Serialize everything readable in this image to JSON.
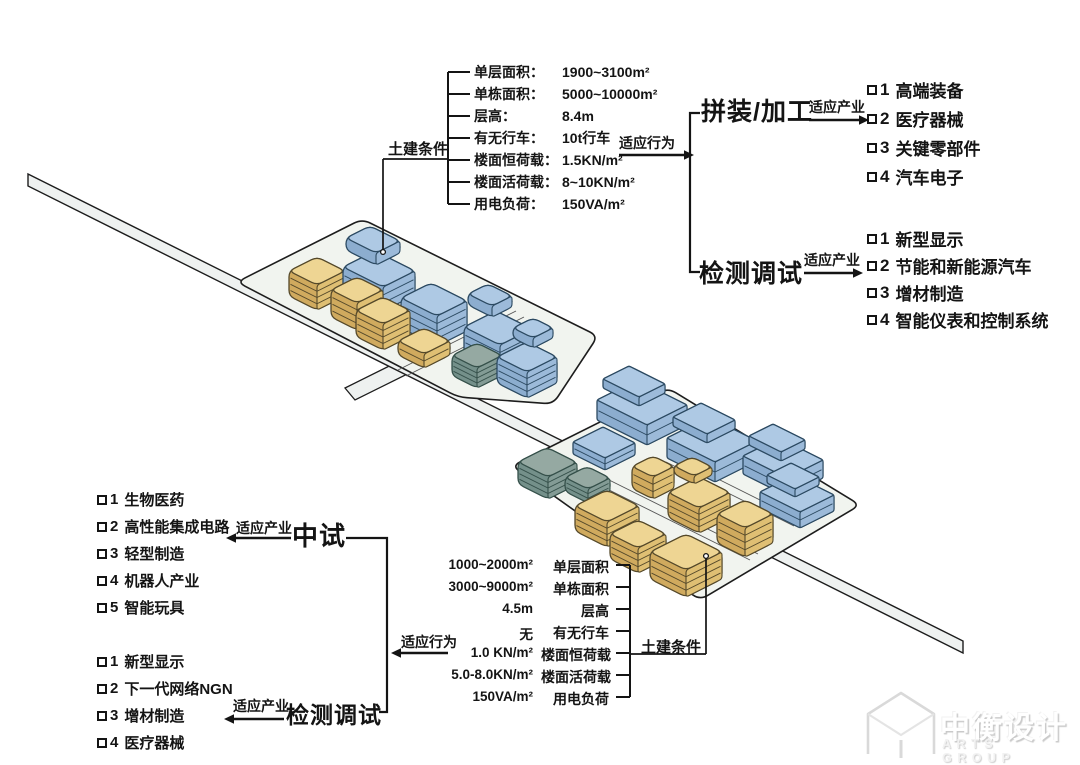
{
  "palette": {
    "ink": "#141414",
    "blue_top": "#aec9e4",
    "blue_left": "#8cadcf",
    "blue_right": "#9cbad9",
    "blue_line": "#2c4a62",
    "yellow_top": "#eed593",
    "yellow_left": "#d0aa5e",
    "yellow_right": "#dfbf73",
    "yellow_line": "#55492a",
    "teal_top": "#95a9a2",
    "teal_left": "#74908a",
    "teal_right": "#839b95",
    "teal_line": "#35504a",
    "plate": "#f1f4ef",
    "road": "#eef1f0",
    "outline": "#1d1d1d"
  },
  "top_conditions": {
    "title": "土建条件",
    "rows": [
      {
        "label": "单层面积：",
        "value": "1900~3100m²"
      },
      {
        "label": "单栋面积：",
        "value": "5000~10000m²"
      },
      {
        "label": "层高：",
        "value": "8.4m"
      },
      {
        "label": "有无行车：",
        "value": "10t行车"
      },
      {
        "label": "楼面恒荷载：",
        "value": "1.5KN/m²"
      },
      {
        "label": "楼面活荷载：",
        "value": "8~10KN/m²"
      },
      {
        "label": "用电负荷：",
        "value": "150VA/m²"
      }
    ]
  },
  "bottom_conditions": {
    "title": "土建条件",
    "rows": [
      {
        "value": "1000~2000m²",
        "label": "单层面积"
      },
      {
        "value": "3000~9000m²",
        "label": "单栋面积"
      },
      {
        "value": "4.5m",
        "label": "层高"
      },
      {
        "value": "无",
        "label": "有无行车"
      },
      {
        "value": "1.0 KN/m²",
        "label": "楼面恒荷载"
      },
      {
        "value": "5.0-8.0KN/m²",
        "label": "楼面活荷载"
      },
      {
        "value": "150VA/m²",
        "label": "用电负荷"
      }
    ]
  },
  "flows": {
    "behavior_top": "适应行为",
    "behavior_bottom": "适应行为",
    "right": [
      {
        "name": "拼装/加工",
        "arrow": "适应产业",
        "items": [
          {
            "n": "1",
            "label": "高端装备"
          },
          {
            "n": "2",
            "label": "医疗器械"
          },
          {
            "n": "3",
            "label": "关键零部件"
          },
          {
            "n": "4",
            "label": "汽车电子"
          }
        ]
      },
      {
        "name": "检测调试",
        "arrow": "适应产业",
        "items": [
          {
            "n": "1",
            "label": "新型显示"
          },
          {
            "n": "2",
            "label": "节能和新能源汽车"
          },
          {
            "n": "3",
            "label": "增材制造"
          },
          {
            "n": "4",
            "label": "智能仪表和控制系统"
          }
        ]
      }
    ],
    "left": [
      {
        "name": "中试",
        "arrow": "适应产业",
        "items": [
          {
            "n": "1",
            "label": "生物医药"
          },
          {
            "n": "2",
            "label": "高性能集成电路"
          },
          {
            "n": "3",
            "label": "轻型制造"
          },
          {
            "n": "4",
            "label": "机器人产业"
          },
          {
            "n": "5",
            "label": "智能玩具"
          }
        ]
      },
      {
        "name": "检测调试",
        "arrow": "适应产业",
        "items": [
          {
            "n": "1",
            "label": "新型显示"
          },
          {
            "n": "2",
            "label": "下一代网络NGN"
          },
          {
            "n": "3",
            "label": "增材制造"
          },
          {
            "n": "4",
            "label": "医疗器械"
          }
        ]
      }
    ]
  },
  "logo": {
    "cn": "中衡设计",
    "en": "ARTS GROUP"
  }
}
